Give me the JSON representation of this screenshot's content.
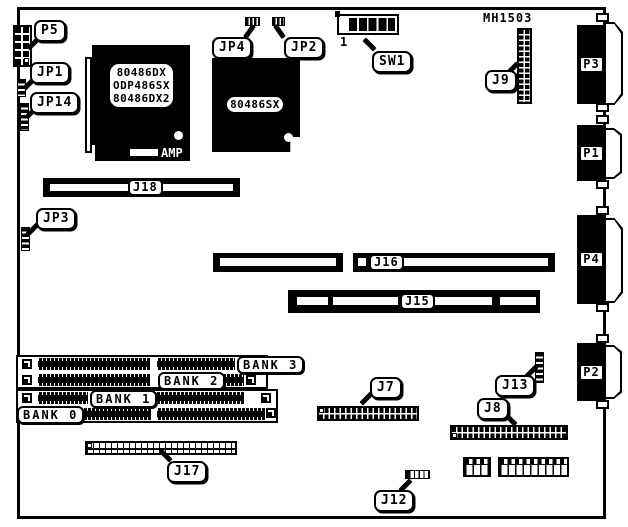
{
  "figure": {
    "part_number": "MH1503",
    "amp_label": "AMP",
    "sw1_pin1_label": "1"
  },
  "chips": {
    "cpu1": {
      "lines": [
        "80486DX",
        "ODP486SX",
        "80486DX2"
      ]
    },
    "cpu2": {
      "label": "80486SX"
    }
  },
  "callouts": {
    "p5": "P5",
    "jp1": "JP1",
    "jp14": "JP14",
    "jp4": "JP4",
    "jp2": "JP2",
    "sw1": "SW1",
    "j9": "J9",
    "j18": "J18",
    "jp3": "JP3",
    "j16": "J16",
    "j15": "J15",
    "j7": "J7",
    "j13": "J13",
    "j8": "J8",
    "j17": "J17",
    "j12": "J12"
  },
  "ports": {
    "p3": "P3",
    "p1": "P1",
    "p4": "P4",
    "p2": "P2"
  },
  "banks": {
    "b3": "BANK 3",
    "b2": "BANK 2",
    "b1": "BANK 1",
    "b0": "BANK 0"
  },
  "colors": {
    "ink": "#000000",
    "paper": "#ffffff"
  }
}
